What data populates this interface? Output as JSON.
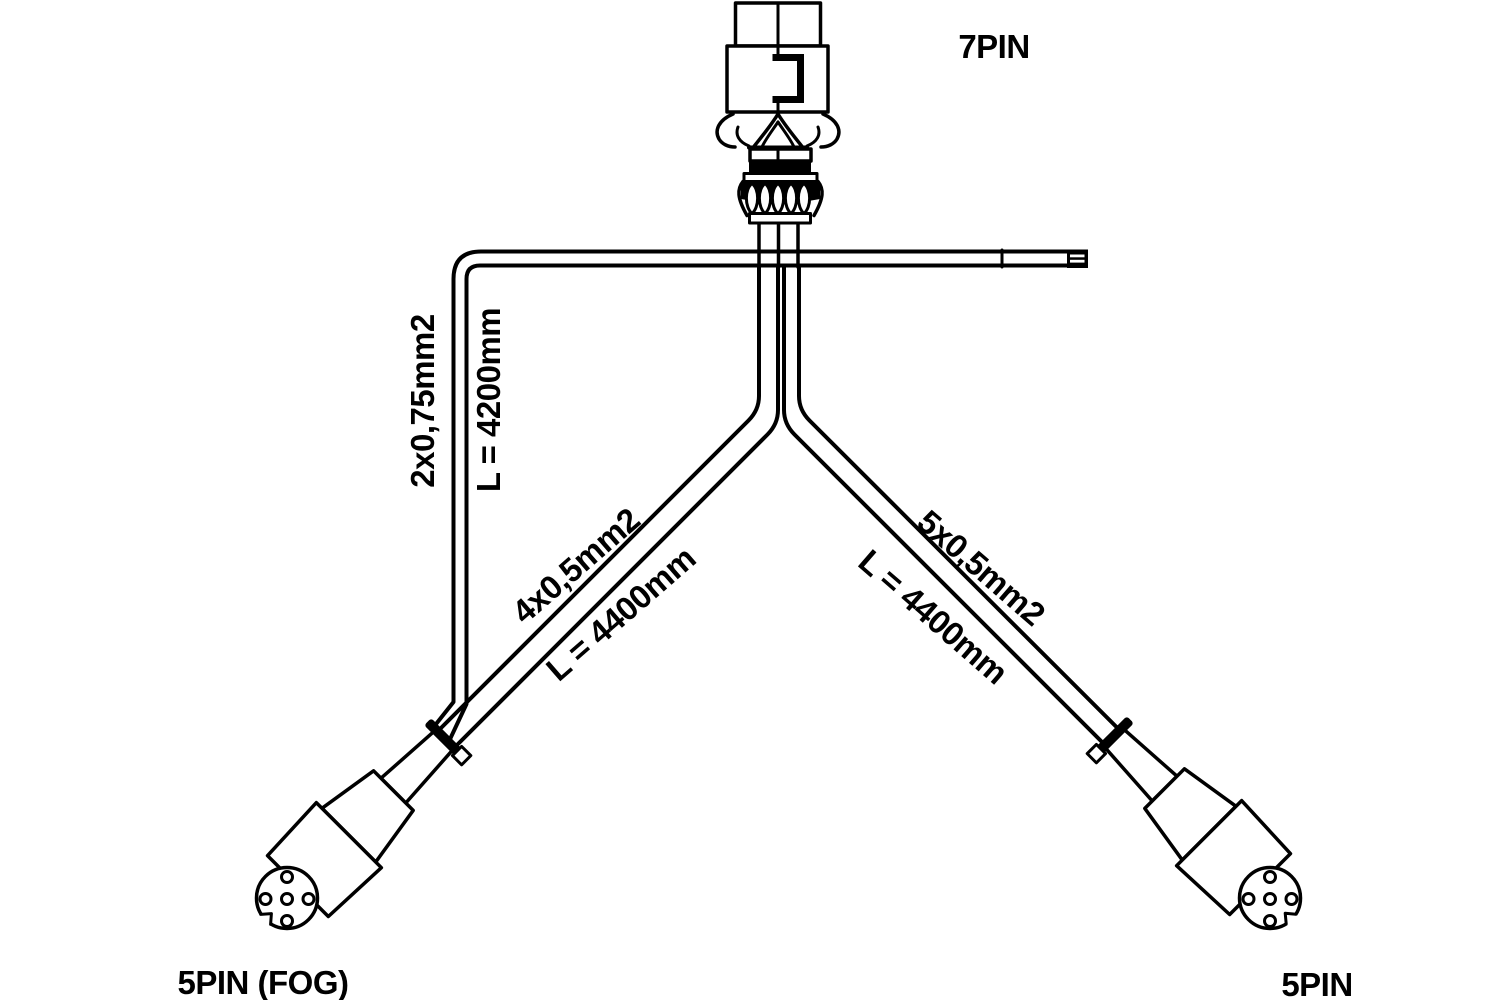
{
  "diagram_title": "Trailer wiring harness diagram",
  "labels": {
    "top_connector": "7PIN",
    "bottom_left_connector": "5PIN (FOG)",
    "bottom_right_connector": "5PIN"
  },
  "cables": [
    {
      "name": "fog-branch-cable",
      "spec": "2x0,75mm2",
      "length": "L = 4200mm"
    },
    {
      "name": "left-branch-cable",
      "spec": "4x0,5mm2",
      "length": "L = 4400mm"
    },
    {
      "name": "right-branch-cable",
      "spec": "5x0,5mm2",
      "length": "L = 4400mm"
    }
  ],
  "connectors": [
    {
      "type": "7PIN",
      "position": "top"
    },
    {
      "type": "5PIN (FOG)",
      "position": "bottom-left",
      "pin_holes": 5
    },
    {
      "type": "5PIN",
      "position": "bottom-right",
      "pin_holes": 5
    }
  ],
  "colors": {
    "ink": "#000000",
    "background": "#ffffff"
  }
}
